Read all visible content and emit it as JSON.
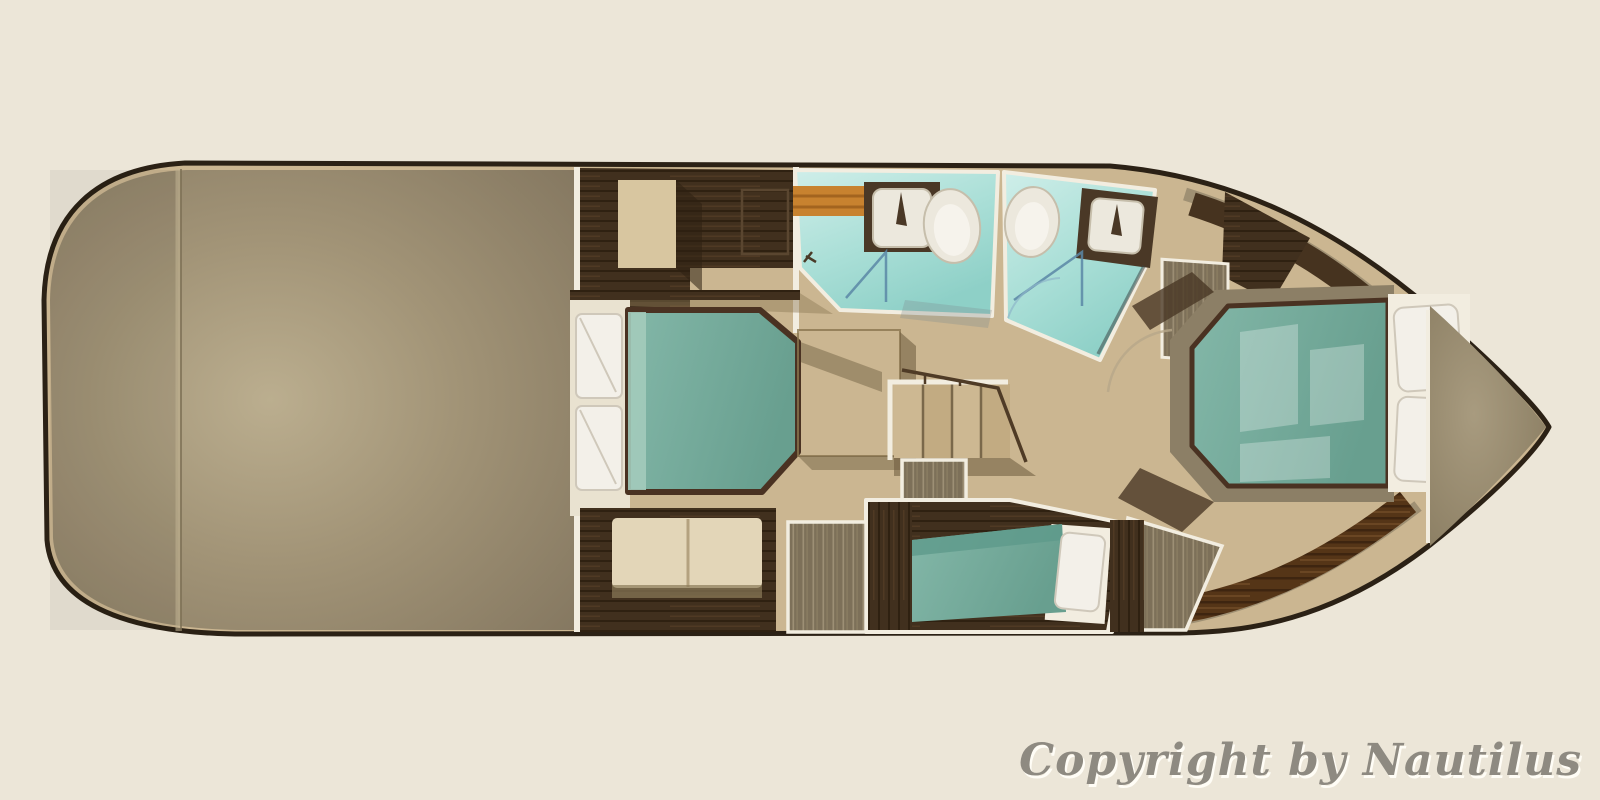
{
  "scene": {
    "type": "yacht-lower-deck-floor-plan-rendering",
    "watermark": "Copyright by Nautilus"
  },
  "palette": {
    "bg": "#ece6d8",
    "outline": "#2b2115",
    "floor": "#cbb691",
    "wall": "#f2ede0",
    "deck-hi": "#b9ac8d",
    "deck-lo": "#877a5f",
    "wood": "#42301e",
    "walnut": "#553517",
    "teak": "#c8822f",
    "aqua-hi": "#cfeee9",
    "aqua-lo": "#8ed0c7",
    "teal-hi": "#83b7a8",
    "teal-lo": "#689f8f",
    "teal-band": "#a3cbbb",
    "glass-blue": "#5b87a6",
    "pillow": "#f3f0e9",
    "pillow-edge": "#cfc8ba",
    "sofa": "#e3d6b8",
    "wardrobe": "#7d7059",
    "wardrobe-streak": "#a2947a",
    "bow-hi": "#a89b7f",
    "bow-lo": "#8b7e62",
    "porcelain": "#ece8dd",
    "shadow": "#6b5a3d",
    "text": "#8e8a81",
    "text-shadow": "#fffdf6"
  },
  "furniture": {
    "stern_deck": [
      "covered-aft-deck"
    ],
    "midship_cabin": [
      "double-bed",
      "pillow",
      "pillow",
      "wardrobe-column",
      "recessed-cabinet",
      "sofa"
    ],
    "bathroom_port": [
      "teak-shelf",
      "sink-vanity",
      "toilet",
      "glass-shower"
    ],
    "bathroom_starboard": [
      "toilet",
      "sink-vanity",
      "glass-shower"
    ],
    "companionway": [
      "staircase",
      "railing",
      "hanging-locker"
    ],
    "lower_cabin": [
      "single-berth",
      "pillow",
      "hanging-locker"
    ],
    "bow_cabin": [
      "island-double-bed",
      "pillow",
      "pillow",
      "hanging-locker",
      "curved-walkway"
    ],
    "bow": [
      "foredeck"
    ]
  }
}
